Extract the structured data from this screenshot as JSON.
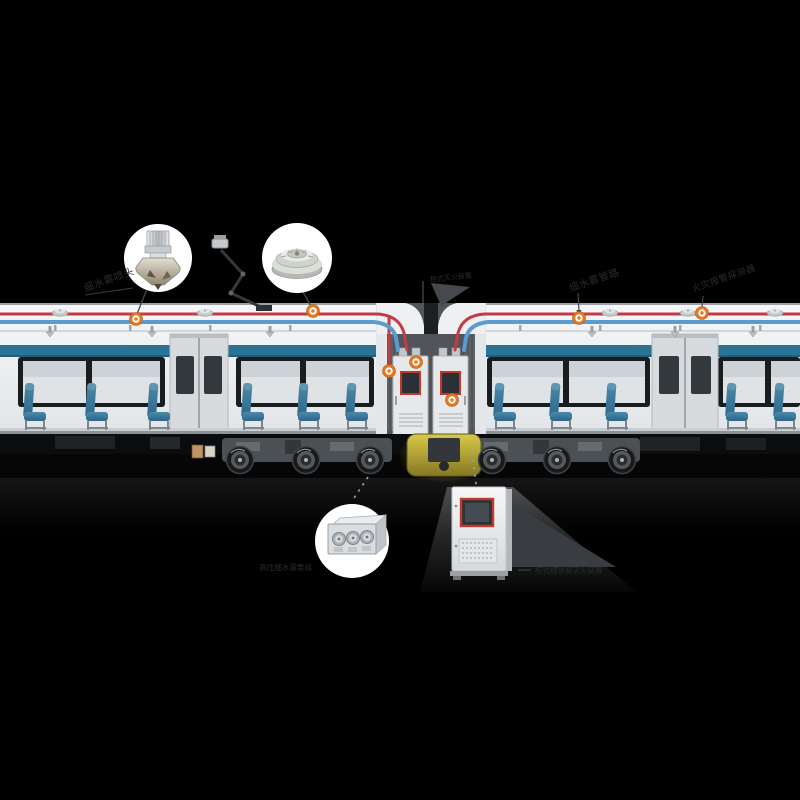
{
  "colors": {
    "background": "#000000",
    "marker_accent": "#e87722",
    "pipe_red": "#c23b45",
    "pipe_blue": "#5b9ccf",
    "seat_teal": "#39759a",
    "underframe_highlight_yellow": "#c9ba42",
    "bubble_background": "#ffffff",
    "label_text": "#2b2b2b",
    "screen_frame_red": "#c0392b"
  },
  "labels": {
    "nozzle": "细水雾喷头",
    "pipeline": "细水雾管路",
    "detector": "火灾报警探测器",
    "suppression_unit": "柜式灭火装置",
    "pump_unit": "高压细水雾泵组",
    "control_cabinet": "柜式细水雾灭火装置"
  },
  "callout_photos": {
    "top_left": "water-mist-nozzle",
    "top_right": "heat-detector",
    "bottom_left": "pump-module",
    "bottom_right": "fire-suppression-control-cabinet"
  },
  "markers": {
    "color": "#e87722",
    "count": 7
  }
}
